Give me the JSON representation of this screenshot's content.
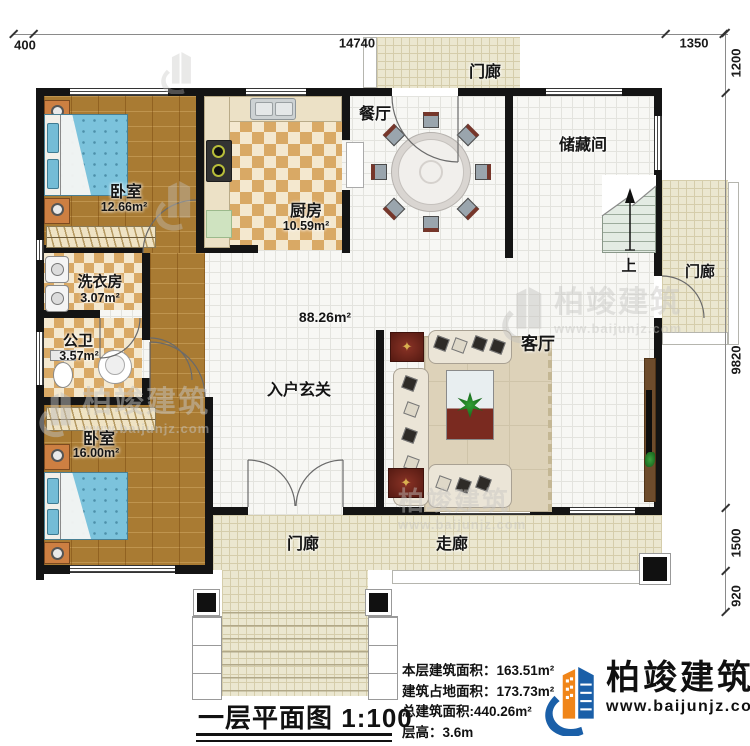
{
  "title_block": {
    "title": "一层平面图",
    "scale": "1:100"
  },
  "info": {
    "rows": [
      {
        "label": "本层建筑面积：",
        "value": "163.51m²"
      },
      {
        "label": "建筑占地面积：",
        "value": "173.73m²"
      },
      {
        "label": "总建筑面积:",
        "value": "440.26m²"
      },
      {
        "label": "层高：",
        "value": "3.6m"
      }
    ]
  },
  "logo": {
    "name": "柏竣建筑",
    "website": "www.baijunjz.com",
    "blue": "#1a5fa8",
    "orange": "#f08519"
  },
  "watermark": {
    "name": "柏竣建筑",
    "website": "www.baijunjz.com"
  },
  "dimensions": {
    "top": [
      "400",
      "14740",
      "1350"
    ],
    "right": [
      "1200",
      "9820",
      "1500",
      "920"
    ]
  },
  "rooms": {
    "bedroom1": {
      "label": "卧室",
      "area": "12.66m²"
    },
    "kitchen": {
      "label": "厨房",
      "area": "10.59m²"
    },
    "dining": {
      "label": "餐厅"
    },
    "storage": {
      "label": "储藏间"
    },
    "hall": {
      "area": "88.26m²"
    },
    "laundry": {
      "label": "洗衣房",
      "area": "3.07m²"
    },
    "bath": {
      "label": "公卫",
      "area": "3.57m²"
    },
    "bedroom2": {
      "label": "卧室",
      "area": "16.00m²"
    },
    "foyer": {
      "label": "入户玄关"
    },
    "living": {
      "label": "客厅"
    },
    "porch_top": {
      "label": "门廊"
    },
    "porch_right": {
      "label": "门廊"
    },
    "porch_bottom": {
      "label": "门廊"
    },
    "corridor": {
      "label": "走廊"
    },
    "stairs": {
      "label": "上"
    }
  }
}
